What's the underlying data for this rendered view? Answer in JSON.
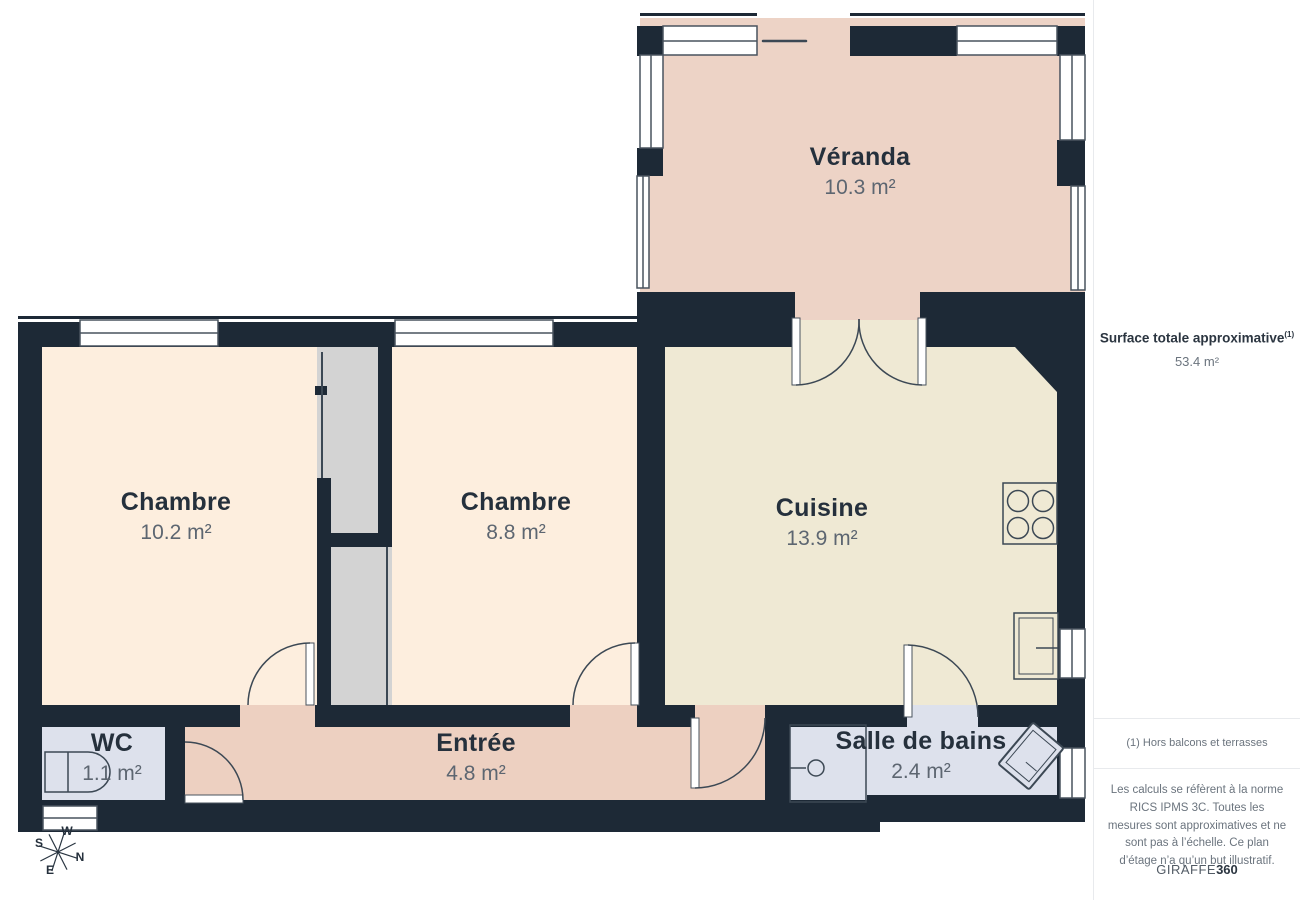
{
  "rooms": [
    {
      "id": "veranda",
      "name": "Véranda",
      "area": "10.3 m²"
    },
    {
      "id": "chambre1",
      "name": "Chambre",
      "area": "10.2 m²"
    },
    {
      "id": "chambre2",
      "name": "Chambre",
      "area": "8.8 m²"
    },
    {
      "id": "cuisine",
      "name": "Cuisine",
      "area": "13.9 m²"
    },
    {
      "id": "wc",
      "name": "WC",
      "area": "1.1 m²"
    },
    {
      "id": "entree",
      "name": "Entrée",
      "area": "4.8 m²"
    },
    {
      "id": "salle_de_bains",
      "name": "Salle de bains",
      "area": "2.4 m²"
    }
  ],
  "sidebar": {
    "title": "Surface totale approximative",
    "title_note_marker": "(1)",
    "total_area": "53.4 m²",
    "footnote": "(1) Hors balcons et terrasses",
    "disclaimer": "Les calculs se réfèrent à la norme RICS IPMS 3C. Toutes les mesures sont approximatives et ne sont pas à l’échelle. Ce plan d’étage n’a qu’un but illustratif.",
    "brand_name": "GIRAFFE",
    "brand_suffix": "360"
  },
  "compass": {
    "w": "W",
    "s": "S",
    "n": "N",
    "e": "E"
  },
  "colors": {
    "wall": "#1d2936",
    "veranda_floor": "#edd3c6",
    "entree_floor": "#edd0c1",
    "chambre_floor": "#fdeede",
    "cuisine_floor": "#efe9d4",
    "wet_room_floor": "#dde1ec",
    "closet": "#d3d3d3",
    "label_dark": "#25303c",
    "label_gray": "#5d6671"
  }
}
